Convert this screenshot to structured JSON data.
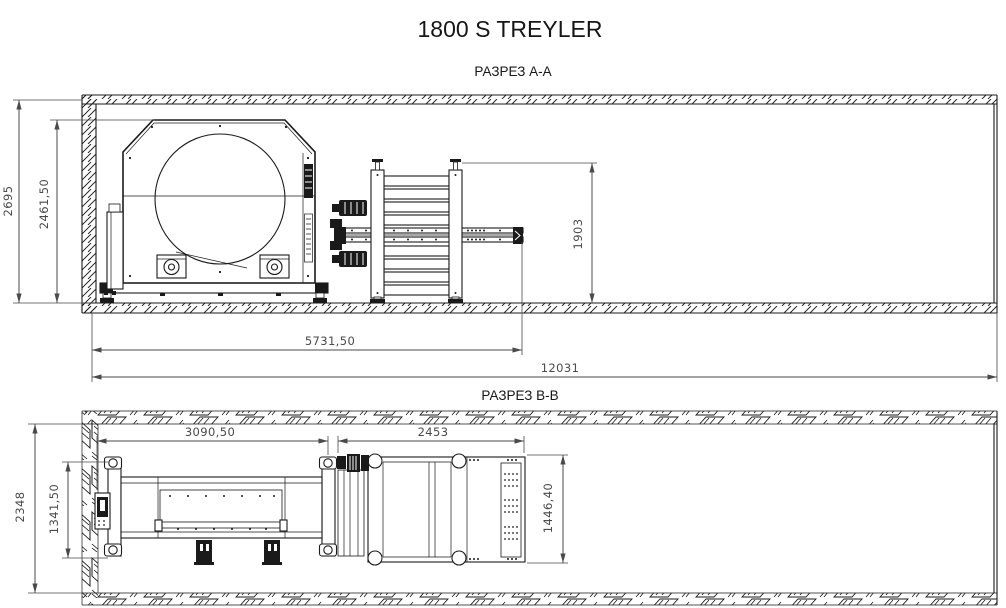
{
  "title": "1800 S TREYLER",
  "colors": {
    "geometry": "#1a1a1a",
    "dimension": "#4a4a4a",
    "background": "#ffffff"
  },
  "sections": {
    "aa": {
      "label": "РАЗРЕЗ A-A",
      "dims": {
        "overall_height": "2695",
        "machine_height": "2461,50",
        "stand_height": "1903",
        "machine_length": "5731,50",
        "total_length": "12031"
      }
    },
    "bb": {
      "label": "РАЗРЕЗ B-B",
      "dims": {
        "overall_height": "2348",
        "machine_width": "1341,50",
        "machine_length": "3090,50",
        "conveyor_length": "2453",
        "conveyor_width": "1446,40"
      }
    }
  }
}
